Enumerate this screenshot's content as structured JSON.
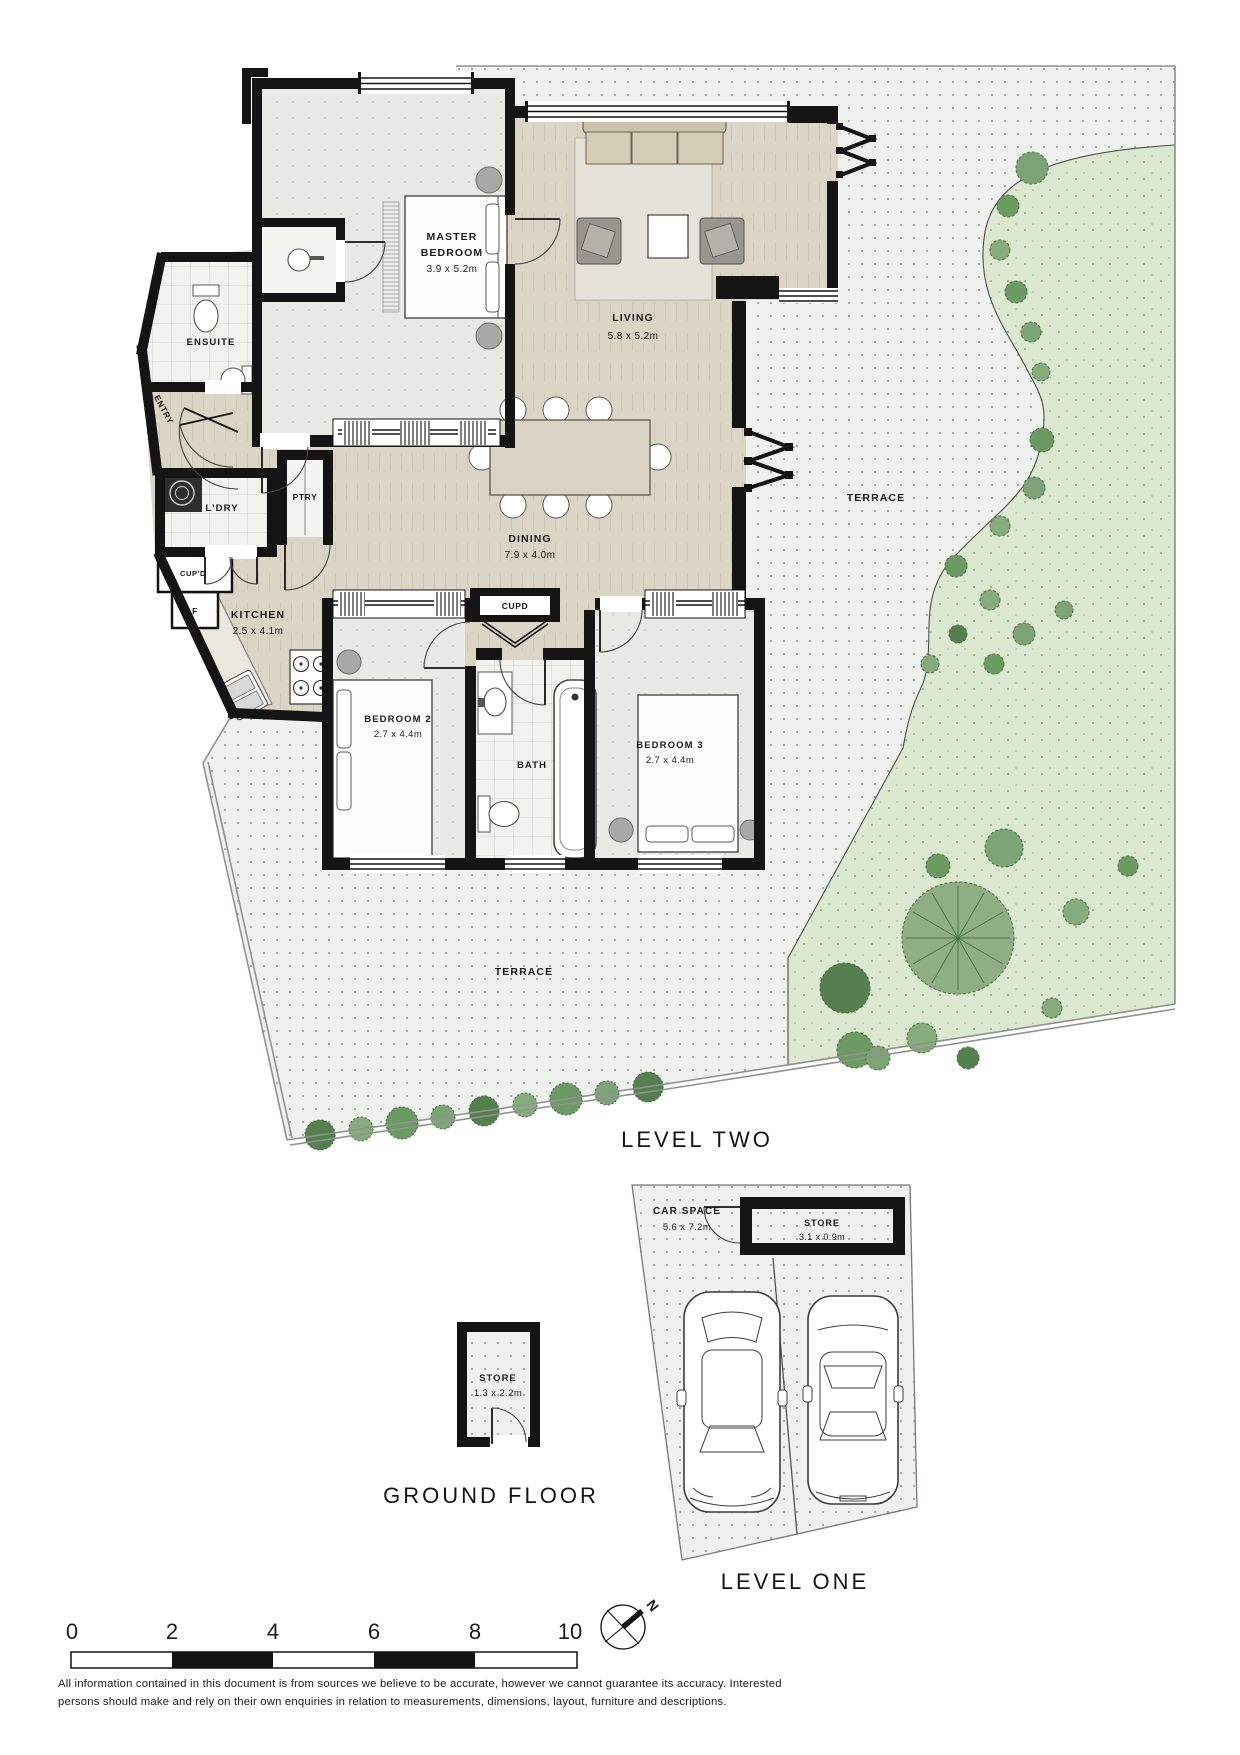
{
  "level_two": {
    "label": "LEVEL TWO",
    "rooms": {
      "master_line1": "MASTER",
      "master_line2": "BEDROOM",
      "master_dims": "3.9 x 5.2m",
      "living": "LIVING",
      "living_dims": "5.8 x 5.2m",
      "ensuite": "ENSUITE",
      "entry": "ENTRY",
      "ldry": "L'DRY",
      "ptry": "PTRY",
      "cupd_small": "CUP'D",
      "fridge": "F",
      "kitchen": "KITCHEN",
      "kitchen_dims": "2.5 x 4.1m",
      "dining": "DINING",
      "dining_dims": "7.9 x 4.0m",
      "cupd_hall": "CUPD",
      "bedroom2": "BEDROOM 2",
      "bedroom2_dims": "2.7 x 4.4m",
      "bath": "BATH",
      "bedroom3": "BEDROOM 3",
      "bedroom3_dims": "2.7 x 4.4m",
      "terrace_upper": "TERRACE",
      "terrace_lower": "TERRACE"
    }
  },
  "ground_floor": {
    "label": "GROUND FLOOR",
    "store": "STORE",
    "store_dims": "1.3 x 2.2m"
  },
  "level_one": {
    "label": "LEVEL ONE",
    "car_space": "CAR SPACE",
    "car_space_dims": "5.6 x 7.2m",
    "store": "STORE",
    "store_dims": "3.1 x 0.9m"
  },
  "scale_bar": {
    "ticks": [
      "0",
      "2",
      "4",
      "6",
      "8",
      "10"
    ]
  },
  "compass": {
    "north": "N"
  },
  "disclaimer": {
    "line1": "All information contained in this document is from sources we believe to be accurate, however we cannot guarantee its accuracy. Interested",
    "line2": "persons should make and rely on their own enquiries in relation to measurements, dimensions, layout, furniture and descriptions."
  },
  "colors": {
    "wall": "#141414",
    "terrace_fill": "#eff1ef",
    "garden_fill": "#dde8d0",
    "floor_open": "#dbd5c6",
    "floor_room": "#e9eae6",
    "tree_green": "#6b9a63"
  }
}
